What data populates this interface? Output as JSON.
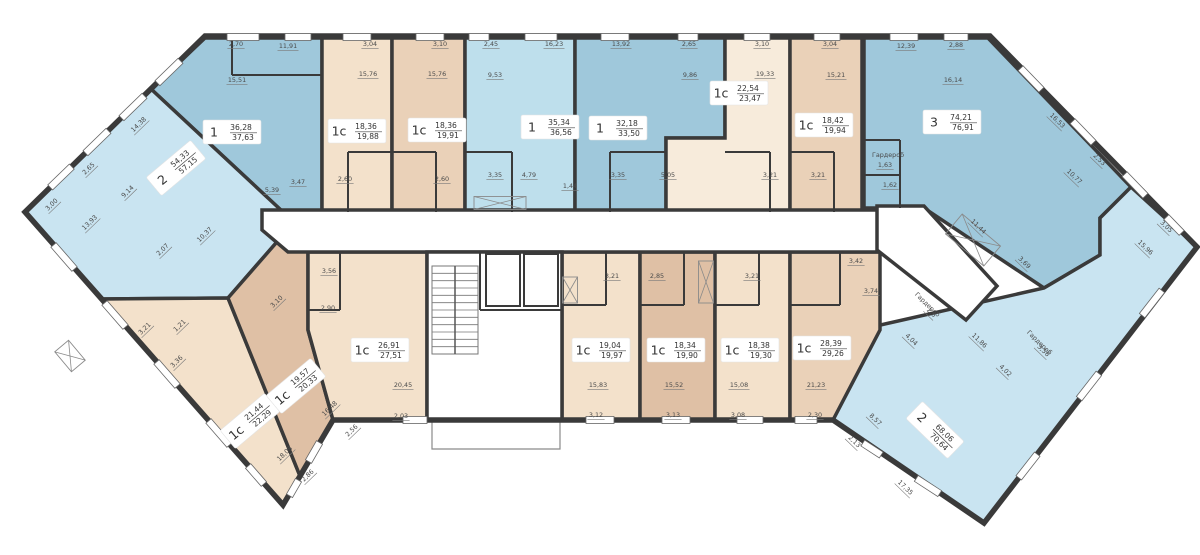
{
  "floor_plan": {
    "bg": "#ffffff",
    "wall_color": "#3a3a3a",
    "palette": {
      "blue_mid": "#9fc8db",
      "blue_light": "#c9e4f1",
      "blue_soft": "#bedfec",
      "tan_light": "#f3e1cb",
      "tan_mid": "#ead1b8",
      "tan_dark": "#dfc0a5",
      "cream": "#f7ebdb",
      "white": "#ffffff"
    },
    "apartments": [
      {
        "id": "1-36-28",
        "type": "1",
        "area_living": "36,28",
        "area_total": "37,63",
        "fill": "blue_mid",
        "poly": "205,38 322,38 322,212 283,212 151,89",
        "label": {
          "x": 232,
          "y": 132,
          "r": 0
        }
      },
      {
        "id": "2-54-33",
        "type": "2",
        "area_living": "54,33",
        "area_total": "57,15",
        "fill": "blue_light",
        "poly": "151,89 283,212 283,235 228,298 103,299 25,212",
        "label": {
          "x": 176,
          "y": 168,
          "r": -40
        }
      },
      {
        "id": "1s-18-36a",
        "type": "1с",
        "area_living": "18,36",
        "area_total": "19,88",
        "fill": "tan_light",
        "poly": "322,38 392,38 392,212 322,212",
        "label": {
          "x": 357,
          "y": 131,
          "r": 0
        }
      },
      {
        "id": "1s-18-36b",
        "type": "1с",
        "area_living": "18,36",
        "area_total": "19,91",
        "fill": "tan_mid",
        "poly": "392,38 465,38 465,212 392,212",
        "label": {
          "x": 437,
          "y": 130,
          "r": 0
        }
      },
      {
        "id": "1-35-34",
        "type": "1",
        "area_living": "35,34",
        "area_total": "36,56",
        "fill": "blue_soft",
        "poly": "465,38 575,38 575,212 465,212",
        "label": {
          "x": 550,
          "y": 127,
          "r": 0
        }
      },
      {
        "id": "1-32-18",
        "type": "1",
        "area_living": "32,18",
        "area_total": "33,50",
        "fill": "blue_mid",
        "poly": "575,38 725,38 725,138 666,138 666,212 575,212",
        "label": {
          "x": 618,
          "y": 128,
          "r": 0
        }
      },
      {
        "id": "1s-22-54",
        "type": "1с",
        "area_living": "22,54",
        "area_total": "23,47",
        "fill": "cream",
        "poly": "725,38 790,38 790,212 666,212 666,138 725,138",
        "label": {
          "x": 739,
          "y": 93,
          "r": 0
        }
      },
      {
        "id": "1s-18-42",
        "type": "1с",
        "area_living": "18,42",
        "area_total": "19,94",
        "fill": "tan_mid",
        "poly": "790,38 862,38 862,212 790,212",
        "label": {
          "x": 824,
          "y": 125,
          "r": 0
        }
      },
      {
        "id": "3-74-21",
        "type": "3",
        "area_living": "74,21",
        "area_total": "76,91",
        "fill": "blue_mid",
        "poly": "864,38 988,38 1131,187 1100,218 1100,255 1044,288 924,208 864,208",
        "label": {
          "x": 952,
          "y": 122,
          "r": 0
        }
      },
      {
        "id": "2-68-06",
        "type": "2",
        "area_living": "68,06",
        "area_total": "70,64",
        "fill": "blue_light",
        "poly": "1131,187 1197,247 984,523 833,420 876,326 1044,288 1100,255 1100,218",
        "label": {
          "x": 935,
          "y": 430,
          "r": 44
        }
      },
      {
        "id": "1s-21-44",
        "type": "1с",
        "area_living": "21,44",
        "area_total": "22,29",
        "fill": "tan_light",
        "poly": "103,299 228,298 300,476 283,505",
        "label": {
          "x": 250,
          "y": 421,
          "r": -40
        }
      },
      {
        "id": "1s-19-57",
        "type": "1с",
        "area_living": "19,57",
        "area_total": "20,33",
        "fill": "tan_dark",
        "poly": "228,298 283,235 308,252 308,330 333,420 300,476",
        "label": {
          "x": 296,
          "y": 386,
          "r": -40
        }
      },
      {
        "id": "1s-26-91",
        "type": "1с",
        "area_living": "26,91",
        "area_total": "27,51",
        "fill": "tan_light",
        "poly": "308,252 427,252 427,420 333,420 308,330",
        "label": {
          "x": 380,
          "y": 350,
          "r": 0
        }
      },
      {
        "id": "1s-19-04",
        "type": "1с",
        "area_living": "19,04",
        "area_total": "19,97",
        "fill": "tan_light",
        "poly": "562,252 640,252 640,420 562,420",
        "label": {
          "x": 601,
          "y": 350,
          "r": 0
        }
      },
      {
        "id": "1s-18-34",
        "type": "1с",
        "area_living": "18,34",
        "area_total": "19,90",
        "fill": "tan_dark",
        "poly": "640,252 715,252 715,420 640,420",
        "label": {
          "x": 676,
          "y": 350,
          "r": 0
        }
      },
      {
        "id": "1s-18-38",
        "type": "1с",
        "area_living": "18,38",
        "area_total": "19,30",
        "fill": "tan_light",
        "poly": "715,252 790,252 790,420 715,420",
        "label": {
          "x": 750,
          "y": 350,
          "r": 0
        }
      },
      {
        "id": "1s-28-39",
        "type": "1с",
        "area_living": "28,39",
        "area_total": "29,26",
        "fill": "tan_mid",
        "poly": "790,252 880,252 880,330 833,420 790,420",
        "label": {
          "x": 822,
          "y": 348,
          "r": 0
        }
      }
    ],
    "white_areas": [
      {
        "name": "corridor",
        "poly": "262,210 898,210 898,252 288,252 262,230",
        "thin": false
      },
      {
        "name": "stair-core",
        "poly": "427,252 562,252 562,420 427,420",
        "thin": false
      },
      {
        "name": "right-hall",
        "poly": "877,206 924,206 997,286 966,320 877,250",
        "thin": false
      },
      {
        "name": "entrance-porch",
        "poly": "432,420 560,420 560,449 432,449",
        "thin": true
      }
    ],
    "shell_outline": "205,36 990,36 1197,247 984,523 833,420 333,420 283,505 25,212",
    "dimensions": [
      [
        "2,70",
        236,
        46,
        0
      ],
      [
        "11,91",
        288,
        48,
        0
      ],
      [
        "3,04",
        370,
        46,
        0
      ],
      [
        "3,10",
        440,
        46,
        0
      ],
      [
        "2,45",
        491,
        46,
        0
      ],
      [
        "16,23",
        554,
        46,
        0
      ],
      [
        "13,92",
        621,
        46,
        0
      ],
      [
        "2,65",
        689,
        46,
        0
      ],
      [
        "3,10",
        762,
        46,
        0
      ],
      [
        "3,04",
        830,
        46,
        0
      ],
      [
        "12,39",
        906,
        48,
        0
      ],
      [
        "2,88",
        956,
        47,
        0
      ],
      [
        "15,51",
        237,
        82,
        0
      ],
      [
        "15,76",
        368,
        76,
        0
      ],
      [
        "15,76",
        437,
        76,
        0
      ],
      [
        "9,53",
        495,
        77,
        0
      ],
      [
        "9,86",
        690,
        77,
        0
      ],
      [
        "19,33",
        765,
        76,
        0
      ],
      [
        "15,21",
        836,
        77,
        0
      ],
      [
        "16,14",
        953,
        82,
        0
      ],
      [
        "5,39",
        272,
        192,
        0
      ],
      [
        "3,47",
        298,
        184,
        0
      ],
      [
        "2,60",
        345,
        181,
        0
      ],
      [
        "2,60",
        442,
        181,
        0
      ],
      [
        "3,35",
        495,
        177,
        0
      ],
      [
        "4,79",
        529,
        177,
        0
      ],
      [
        "1,44",
        570,
        188,
        0
      ],
      [
        "3,35",
        618,
        177,
        0
      ],
      [
        "5,05",
        668,
        177,
        0
      ],
      [
        "3,21",
        770,
        177,
        0
      ],
      [
        "3,21",
        818,
        177,
        0
      ],
      [
        "Гардероб",
        888,
        157,
        0
      ],
      [
        "1,63",
        885,
        167,
        0
      ],
      [
        "1,62",
        890,
        187,
        0
      ],
      [
        "3,21",
        612,
        278,
        0
      ],
      [
        "2,85",
        657,
        278,
        0
      ],
      [
        "3,21",
        752,
        278,
        0
      ],
      [
        "3,42",
        856,
        263,
        0
      ],
      [
        "3,74",
        871,
        293,
        0
      ],
      [
        "15,83",
        598,
        387,
        0
      ],
      [
        "3,12",
        596,
        417,
        0
      ],
      [
        "15,52",
        674,
        387,
        0
      ],
      [
        "3,13",
        673,
        417,
        0
      ],
      [
        "15,08",
        739,
        387,
        0
      ],
      [
        "3,08",
        738,
        417,
        0
      ],
      [
        "21,23",
        816,
        387,
        0
      ],
      [
        "2,30",
        815,
        417,
        0
      ],
      [
        "3,56",
        329,
        273,
        0
      ],
      [
        "2,90",
        328,
        310,
        0
      ],
      [
        "20,45",
        403,
        387,
        0
      ],
      [
        "2,03",
        401,
        418,
        0
      ],
      [
        "14,38",
        140,
        126,
        -44
      ],
      [
        "2,65",
        90,
        170,
        -44
      ],
      [
        "9,14",
        129,
        193,
        -44
      ],
      [
        "3,00",
        53,
        206,
        -44
      ],
      [
        "13,93",
        91,
        224,
        -44
      ],
      [
        "10,37",
        206,
        236,
        -44
      ],
      [
        "2,07",
        164,
        251,
        -44
      ],
      [
        "3,21",
        146,
        330,
        -44
      ],
      [
        "1,21",
        181,
        327,
        -44
      ],
      [
        "3,10",
        278,
        303,
        -44
      ],
      [
        "3,36",
        178,
        363,
        -44
      ],
      [
        "16,48",
        331,
        410,
        -44
      ],
      [
        "2,56",
        353,
        432,
        -44
      ],
      [
        "18,08",
        286,
        455,
        -44
      ],
      [
        "2,86",
        309,
        477,
        -44
      ],
      [
        "16,53",
        1056,
        122,
        44
      ],
      [
        "2,53",
        1098,
        161,
        44
      ],
      [
        "10,77",
        1073,
        178,
        44
      ],
      [
        "3,05",
        1165,
        228,
        44
      ],
      [
        "15,96",
        1144,
        249,
        44
      ],
      [
        "11,44",
        977,
        228,
        44
      ],
      [
        "3,69",
        1023,
        264,
        44
      ],
      [
        "Гардероб",
        926,
        306,
        44
      ],
      [
        "2,6",
        930,
        314,
        44
      ],
      [
        "4,04",
        910,
        341,
        44
      ],
      [
        "11,86",
        978,
        342,
        44
      ],
      [
        "Гардероб",
        1038,
        344,
        44
      ],
      [
        "3,56",
        1042,
        352,
        44
      ],
      [
        "4,02",
        1004,
        372,
        44
      ],
      [
        "8,57",
        874,
        421,
        44
      ],
      [
        "2,13",
        853,
        443,
        44
      ],
      [
        "17,35",
        904,
        489,
        44
      ]
    ],
    "windows": [
      [
        243,
        37,
        32,
        0
      ],
      [
        298,
        37,
        26,
        0
      ],
      [
        357,
        37,
        28,
        0
      ],
      [
        430,
        37,
        28,
        0
      ],
      [
        479,
        37,
        20,
        0
      ],
      [
        541,
        37,
        32,
        0
      ],
      [
        615,
        37,
        28,
        0
      ],
      [
        688,
        37,
        20,
        0
      ],
      [
        757,
        37,
        26,
        0
      ],
      [
        827,
        37,
        26,
        0
      ],
      [
        904,
        37,
        28,
        0
      ],
      [
        956,
        37,
        24,
        0
      ],
      [
        169,
        72,
        32,
        -44
      ],
      [
        133,
        107,
        32,
        -44
      ],
      [
        97,
        142,
        32,
        -44
      ],
      [
        61,
        177,
        30,
        -44
      ],
      [
        64,
        257,
        32,
        49
      ],
      [
        115,
        315,
        32,
        49
      ],
      [
        167,
        374,
        32,
        49
      ],
      [
        219,
        433,
        32,
        49
      ],
      [
        256,
        475,
        24,
        49
      ],
      [
        1031,
        79,
        30,
        46
      ],
      [
        1083,
        132,
        30,
        46
      ],
      [
        1135,
        185,
        30,
        46
      ],
      [
        1174,
        225,
        22,
        46
      ],
      [
        1152,
        303,
        32,
        -52
      ],
      [
        1089,
        386,
        32,
        -52
      ],
      [
        1028,
        466,
        30,
        -52
      ],
      [
        928,
        486,
        28,
        33
      ],
      [
        872,
        449,
        22,
        33
      ],
      [
        600,
        420,
        28,
        0
      ],
      [
        676,
        420,
        28,
        0
      ],
      [
        750,
        420,
        26,
        0
      ],
      [
        806,
        420,
        22,
        0
      ],
      [
        415,
        420,
        24,
        0
      ],
      [
        314,
        452,
        22,
        -60
      ],
      [
        294,
        488,
        18,
        -60
      ]
    ],
    "cross_boxes": [
      [
        500,
        203,
        52,
        13,
        0
      ],
      [
        570,
        290,
        15,
        26,
        0
      ],
      [
        706,
        282,
        15,
        42,
        0
      ],
      [
        973,
        240,
        50,
        26,
        40
      ],
      [
        70,
        356,
        18,
        26,
        -40
      ]
    ],
    "thin_walls": [
      [
        348,
        152,
        392,
        152
      ],
      [
        348,
        152,
        348,
        212
      ],
      [
        392,
        152,
        436,
        152
      ],
      [
        436,
        152,
        436,
        212
      ],
      [
        465,
        152,
        512,
        152
      ],
      [
        512,
        152,
        512,
        212
      ],
      [
        610,
        152,
        666,
        152
      ],
      [
        610,
        152,
        610,
        212
      ],
      [
        725,
        152,
        770,
        152
      ],
      [
        770,
        152,
        770,
        212
      ],
      [
        790,
        152,
        834,
        152
      ],
      [
        834,
        152,
        834,
        212
      ],
      [
        562,
        305,
        606,
        305
      ],
      [
        606,
        252,
        606,
        305
      ],
      [
        640,
        305,
        684,
        305
      ],
      [
        684,
        252,
        684,
        305
      ],
      [
        715,
        305,
        759,
        305
      ],
      [
        759,
        252,
        759,
        305
      ],
      [
        790,
        305,
        840,
        305
      ],
      [
        840,
        252,
        840,
        305
      ],
      [
        340,
        252,
        340,
        310
      ],
      [
        308,
        310,
        340,
        310
      ],
      [
        862,
        140,
        900,
        140
      ],
      [
        900,
        140,
        900,
        208
      ],
      [
        862,
        175,
        900,
        175
      ],
      [
        232,
        38,
        232,
        75
      ],
      [
        232,
        75,
        322,
        75
      ],
      [
        480,
        252,
        480,
        310
      ],
      [
        480,
        310,
        562,
        310
      ]
    ],
    "stairs": {
      "x": 432,
      "y": 266,
      "w": 46,
      "h": 88,
      "steps": 11
    },
    "elevators": [
      [
        486,
        254,
        34,
        52
      ],
      [
        524,
        254,
        34,
        52
      ]
    ]
  }
}
